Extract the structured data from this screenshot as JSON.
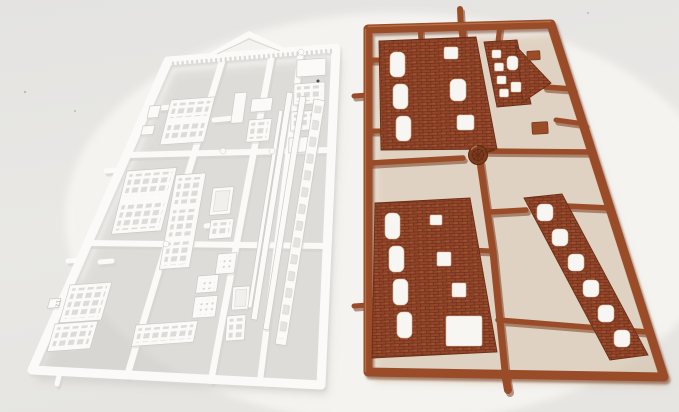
{
  "image": {
    "type": "product-photo",
    "subject": "Two injection-moulded plastic model-kit sprues (parts frames) for a model railway building, lying side by side",
    "background": "plain light-grey studio backdrop over a white sheet",
    "left_sprue_summary": "white styrene sprue with window panels, door panels, cornice strips and a roof pediment",
    "right_sprue_summary": "red-brown styrene sprue with brick-textured wall panels that have arched window and door openings"
  },
  "palette": {
    "backdrop_top": "#e4e3e1",
    "backdrop_mid": "#e9e8e5",
    "backdrop_bottom": "#e6e5e2",
    "sheet_white": "#f7f6f3",
    "white_plastic": "#fbfaf8",
    "white_plastic_shadow": "#d8d7d3",
    "white_plastic_edge": "#cbcac6",
    "brown_plastic": "#9a4c28",
    "brown_plastic_dark": "#6b2f15",
    "brown_plastic_light": "#c08255",
    "brick_base": "#91452a",
    "brick_joint": "#6f3018",
    "brick_light": "#aa5c36",
    "shadow_grey": "#c9c7c3",
    "shadow_tan": "#d5bfa6"
  },
  "sprues": {
    "white": {
      "name": "white-detail-sprue",
      "color_name": "white",
      "tag_label": "12",
      "parts": [
        "triangular roof pediment",
        "cornice strip with dentil moulding",
        "multi-pane window wall panels",
        "panelled door sections",
        "small lattice window frames",
        "long ridge and trim strips",
        "ladder strip with rectangular openings",
        "moulded part-number tag"
      ]
    },
    "brown": {
      "name": "brick-wall-sprue",
      "color_name": "red-brown",
      "parts": [
        "large brick wall panel with arched window openings",
        "brick gable-end wall panel with pointed roofline",
        "tall brick wall panel with door and window openings",
        "narrow brick pilaster strip with a ladder of window openings",
        "small brick wall tabs",
        "round injection-gate knob on centre runner"
      ]
    }
  }
}
